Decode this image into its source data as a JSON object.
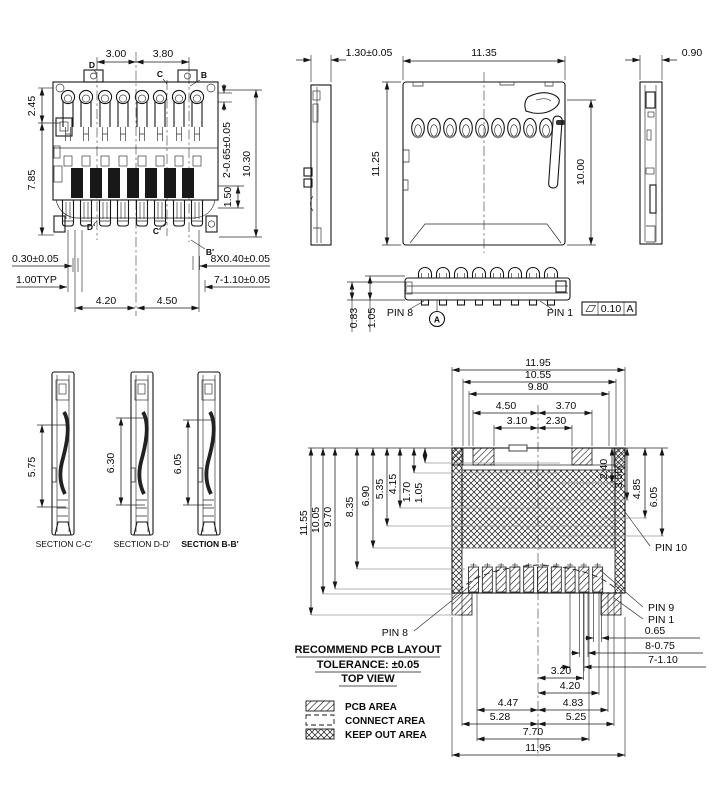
{
  "drawing": {
    "front_view": {
      "top_dims": [
        "3.00",
        "3.80"
      ],
      "left_dims": [
        "2.45",
        "7.85"
      ],
      "right_dims": [
        "2-0.65±0.05",
        "10.30",
        "1.50"
      ],
      "bottom_left_dims": [
        "0.30±0.05",
        "1.00TYP"
      ],
      "bottom_dims": [
        "4.20",
        "4.50"
      ],
      "bottom_right_dims": [
        "8X0.40±0.05",
        "7-1.10±0.05"
      ],
      "section_marks": [
        "D",
        "C",
        "B",
        "D'",
        "C'",
        "B'"
      ]
    },
    "top_view": {
      "thickness": "1.30±0.05",
      "width": "11.35",
      "height": "11.25",
      "shield_height": "10.00"
    },
    "right_side_view": {
      "thickness": "0.90"
    },
    "bottom_side_view": {
      "height_dims": [
        "0.83",
        "1.05"
      ],
      "pin_left": "PIN 8",
      "pin_right": "PIN 1",
      "datum": "A",
      "flatness_tol": "0.10",
      "flatness_datum": "A"
    },
    "sections": [
      {
        "dim": "5.75",
        "label": "SECTION C-C'"
      },
      {
        "dim": "6.30",
        "label": "SECTION D-D'"
      },
      {
        "dim": "6.05",
        "label": "SECTION B-B'"
      }
    ],
    "pcb_layout": {
      "top_widths": [
        "11.95",
        "10.55",
        "9.80",
        "4.50",
        "3.70",
        "3.10",
        "2.30"
      ],
      "left_heights": [
        "11.55",
        "10.05",
        "9.70",
        "8.35",
        "6.90",
        "5.35",
        "4.15",
        "1.70",
        "1.05"
      ],
      "right_heights": [
        "2.40",
        "3.55",
        "4.85",
        "6.05"
      ],
      "pin_labels": [
        "PIN 10",
        "PIN 9",
        "PIN 1",
        "PIN 8"
      ],
      "pad_dims": [
        "0.65",
        "8-0.75",
        "7-1.10"
      ],
      "bottom_widths": [
        "3.20",
        "4.20",
        "4.47",
        "4.83",
        "5.28",
        "5.25",
        "7.70",
        "11.95"
      ],
      "notes": [
        "RECOMMEND PCB LAYOUT",
        "TOLERANCE: ±0.05",
        "TOP VIEW"
      ],
      "legend": [
        {
          "label": "PCB AREA"
        },
        {
          "label": "CONNECT AREA"
        },
        {
          "label": "KEEP OUT AREA"
        }
      ]
    }
  }
}
